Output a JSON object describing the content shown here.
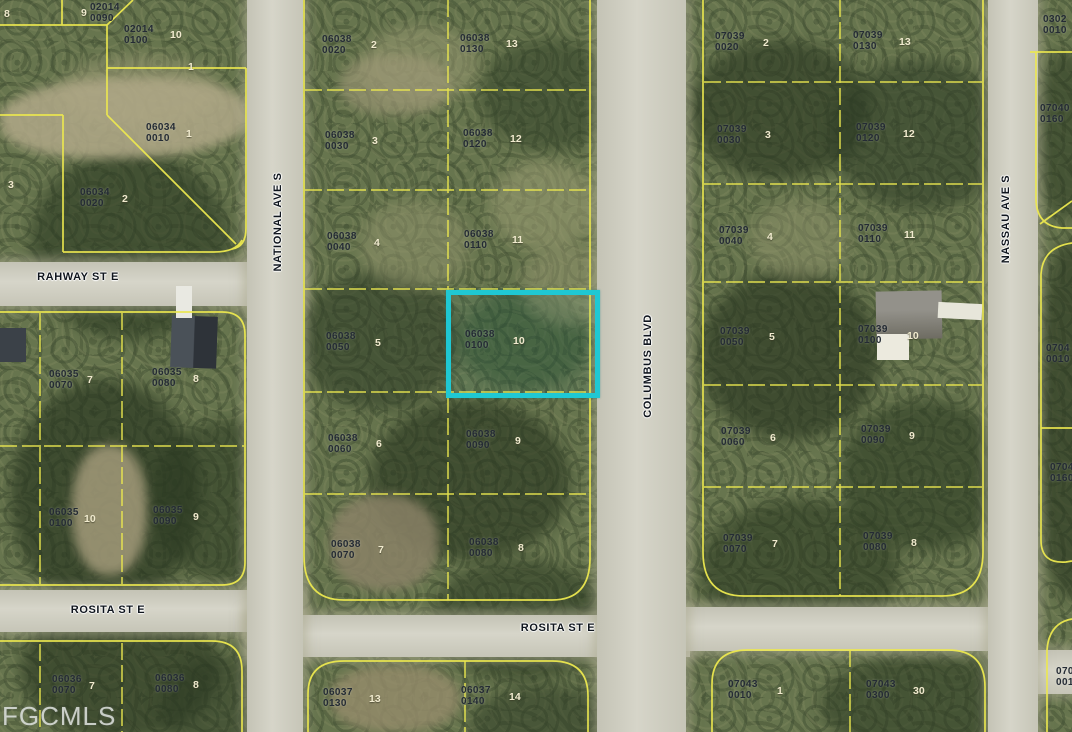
{
  "watermark": "FGCMLS",
  "highlight": {
    "parcel": "06038 0100",
    "color": "#1fc8d3",
    "x": 446,
    "y": 290,
    "w": 144,
    "h": 98
  },
  "street_labels": [
    {
      "name": "RAHWAY ST E",
      "x": 78,
      "y": 277,
      "rot": 0
    },
    {
      "name": "ROSITA ST E",
      "x": 108,
      "y": 610,
      "rot": 0
    },
    {
      "name": "ROSITA ST E",
      "x": 558,
      "y": 628,
      "rot": 0
    },
    {
      "name": "NATIONAL AVE S",
      "x": 278,
      "y": 222,
      "rot": -90
    },
    {
      "name": "COLUMBUS BLVD",
      "x": 648,
      "y": 366,
      "rot": -90
    },
    {
      "name": "NASSAU AVE S",
      "x": 1006,
      "y": 219,
      "rot": -90
    }
  ],
  "parcel_labels": [
    {
      "line1": "02014",
      "line2": "0090",
      "lot": "9",
      "x": 90,
      "y": 2,
      "lotx": 81,
      "loty": 7
    },
    {
      "line1": "02014",
      "line2": "0100",
      "lot": "10",
      "x": 124,
      "y": 24,
      "lotx": 170,
      "loty": 29
    },
    {
      "line1": "06034",
      "line2": "0010",
      "lot": "1",
      "x": 146,
      "y": 122,
      "lotx": 186,
      "loty": 128
    },
    {
      "line1": "06034",
      "line2": "0020",
      "lot": "2",
      "x": 80,
      "y": 187,
      "lotx": 122,
      "loty": 193
    },
    {
      "line1": "06035",
      "line2": "0070",
      "lot": "7",
      "x": 49,
      "y": 369,
      "lotx": 87,
      "loty": 374
    },
    {
      "line1": "06035",
      "line2": "0080",
      "lot": "8",
      "x": 152,
      "y": 367,
      "lotx": 193,
      "loty": 373
    },
    {
      "line1": "06035",
      "line2": "0100",
      "lot": "10",
      "x": 49,
      "y": 507,
      "lotx": 84,
      "loty": 513
    },
    {
      "line1": "06035",
      "line2": "0090",
      "lot": "9",
      "x": 153,
      "y": 505,
      "lotx": 193,
      "loty": 511
    },
    {
      "line1": "06036",
      "line2": "0070",
      "lot": "7",
      "x": 52,
      "y": 674,
      "lotx": 89,
      "loty": 680
    },
    {
      "line1": "06036",
      "line2": "0080",
      "lot": "8",
      "x": 155,
      "y": 673,
      "lotx": 193,
      "loty": 679
    },
    {
      "line1": "06038",
      "line2": "0020",
      "lot": "2",
      "x": 322,
      "y": 34,
      "lotx": 371,
      "loty": 39
    },
    {
      "line1": "06038",
      "line2": "0130",
      "lot": "13",
      "x": 460,
      "y": 33,
      "lotx": 506,
      "loty": 38
    },
    {
      "line1": "06038",
      "line2": "0030",
      "lot": "3",
      "x": 325,
      "y": 130,
      "lotx": 372,
      "loty": 135
    },
    {
      "line1": "06038",
      "line2": "0120",
      "lot": "12",
      "x": 463,
      "y": 128,
      "lotx": 510,
      "loty": 133
    },
    {
      "line1": "06038",
      "line2": "0040",
      "lot": "4",
      "x": 327,
      "y": 231,
      "lotx": 374,
      "loty": 237
    },
    {
      "line1": "06038",
      "line2": "0110",
      "lot": "11",
      "x": 464,
      "y": 229,
      "lotx": 512,
      "loty": 234
    },
    {
      "line1": "06038",
      "line2": "0050",
      "lot": "5",
      "x": 326,
      "y": 331,
      "lotx": 375,
      "loty": 337
    },
    {
      "line1": "06038",
      "line2": "0100",
      "lot": "10",
      "x": 465,
      "y": 329,
      "lotx": 513,
      "loty": 335
    },
    {
      "line1": "06038",
      "line2": "0060",
      "lot": "6",
      "x": 328,
      "y": 433,
      "lotx": 376,
      "loty": 438
    },
    {
      "line1": "06038",
      "line2": "0090",
      "lot": "9",
      "x": 466,
      "y": 429,
      "lotx": 515,
      "loty": 435
    },
    {
      "line1": "06038",
      "line2": "0070",
      "lot": "7",
      "x": 331,
      "y": 539,
      "lotx": 378,
      "loty": 544
    },
    {
      "line1": "06038",
      "line2": "0080",
      "lot": "8",
      "x": 469,
      "y": 537,
      "lotx": 518,
      "loty": 542
    },
    {
      "line1": "06037",
      "line2": "0130",
      "lot": "13",
      "x": 323,
      "y": 687,
      "lotx": 369,
      "loty": 693
    },
    {
      "line1": "06037",
      "line2": "0140",
      "lot": "14",
      "x": 461,
      "y": 685,
      "lotx": 509,
      "loty": 691
    },
    {
      "line1": "07039",
      "line2": "0020",
      "lot": "2",
      "x": 715,
      "y": 31,
      "lotx": 763,
      "loty": 37
    },
    {
      "line1": "07039",
      "line2": "0130",
      "lot": "13",
      "x": 853,
      "y": 30,
      "lotx": 899,
      "loty": 36
    },
    {
      "line1": "07039",
      "line2": "0030",
      "lot": "3",
      "x": 717,
      "y": 124,
      "lotx": 765,
      "loty": 129
    },
    {
      "line1": "07039",
      "line2": "0120",
      "lot": "12",
      "x": 856,
      "y": 122,
      "lotx": 903,
      "loty": 128
    },
    {
      "line1": "07039",
      "line2": "0040",
      "lot": "4",
      "x": 719,
      "y": 225,
      "lotx": 767,
      "loty": 231
    },
    {
      "line1": "07039",
      "line2": "0110",
      "lot": "11",
      "x": 858,
      "y": 223,
      "lotx": 904,
      "loty": 229
    },
    {
      "line1": "07039",
      "line2": "0050",
      "lot": "5",
      "x": 720,
      "y": 326,
      "lotx": 769,
      "loty": 331
    },
    {
      "line1": "07039",
      "line2": "0100",
      "lot": "10",
      "x": 858,
      "y": 324,
      "lotx": 907,
      "loty": 330
    },
    {
      "line1": "07039",
      "line2": "0060",
      "lot": "6",
      "x": 721,
      "y": 426,
      "lotx": 770,
      "loty": 432
    },
    {
      "line1": "07039",
      "line2": "0090",
      "lot": "9",
      "x": 861,
      "y": 424,
      "lotx": 909,
      "loty": 430
    },
    {
      "line1": "07039",
      "line2": "0070",
      "lot": "7",
      "x": 723,
      "y": 533,
      "lotx": 772,
      "loty": 538
    },
    {
      "line1": "07039",
      "line2": "0080",
      "lot": "8",
      "x": 863,
      "y": 531,
      "lotx": 911,
      "loty": 537
    },
    {
      "line1": "07043",
      "line2": "0010",
      "lot": "1",
      "x": 728,
      "y": 679,
      "lotx": 777,
      "loty": 685
    },
    {
      "line1": "07043",
      "line2": "0300",
      "lot": "30",
      "x": 866,
      "y": 679,
      "lotx": 913,
      "loty": 685
    },
    {
      "line1": "0302",
      "line2": "0010",
      "lot": "",
      "x": 1043,
      "y": 14,
      "lotx": 0,
      "loty": 0
    },
    {
      "line1": "07040",
      "line2": "0160",
      "lot": "",
      "x": 1040,
      "y": 103,
      "lotx": 0,
      "loty": 0
    },
    {
      "line1": "0704",
      "line2": "0010",
      "lot": "",
      "x": 1046,
      "y": 343,
      "lotx": 0,
      "loty": 0
    },
    {
      "line1": "0704",
      "line2": "0160",
      "lot": "",
      "x": 1050,
      "y": 462,
      "lotx": 0,
      "loty": 0
    },
    {
      "line1": "070",
      "line2": "001",
      "lot": "",
      "x": 1056,
      "y": 666,
      "lotx": 0,
      "loty": 0
    }
  ],
  "lone_lots": [
    {
      "lot": "8",
      "x": 4,
      "y": 8
    },
    {
      "lot": "1",
      "x": 188,
      "y": 61
    },
    {
      "lot": "3",
      "x": 8,
      "y": 179
    }
  ]
}
